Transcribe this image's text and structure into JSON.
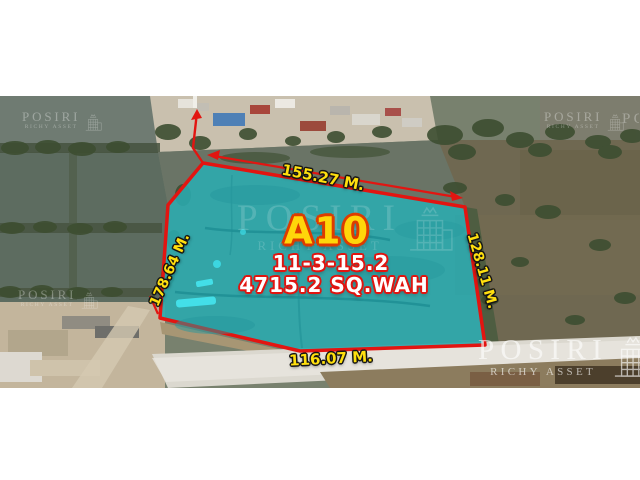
{
  "listing": {
    "plot_label": "A10",
    "area_rai_ngan_wah": "11-3-15.2",
    "area_sq_wah": "4715.2 SQ.WAH",
    "side_top": "155.27 M.",
    "side_right": "128.11 M.",
    "side_left": "178.64 M.",
    "side_bottom": "116.07 M."
  },
  "watermark": {
    "brand": "POSIRI",
    "sub": "RICHY ASSET"
  },
  "colors": {
    "plot_fill": "#2ba9ad",
    "plot_border": "#e21511",
    "plot_label_yellow": "#ffd60a",
    "plot_label_outline": "#dd3c00",
    "measure_text_yellow": "#ffdf0e",
    "area_text_white": "#ffffff",
    "area_text_outline_red": "#e01510",
    "watermark_white": "#ffffff",
    "canvas_background": "#ffffff"
  }
}
